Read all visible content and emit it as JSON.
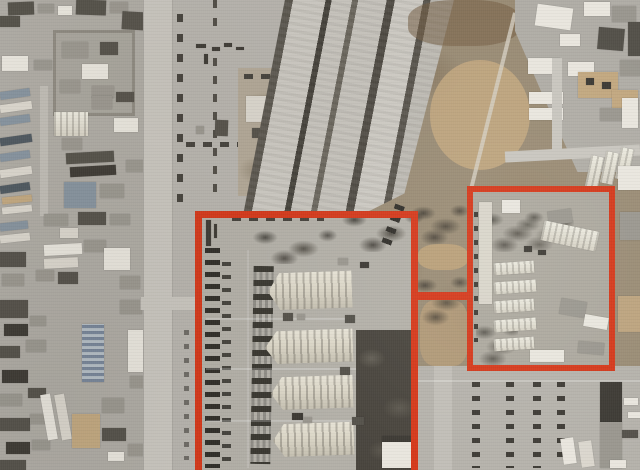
{
  "window": {
    "width": 640,
    "height": 470
  },
  "scene": {
    "kind": "satellite-aerial-photograph",
    "subject": "airbase-with-highlighted-compounds",
    "visible_text": ""
  },
  "annotation_color": "#d5381a",
  "annotations": [
    {
      "name": "highlight-box-main",
      "x": 195,
      "y": 211,
      "w": 223,
      "h": 266,
      "stroke": 7,
      "fill": false
    },
    {
      "name": "highlight-box-secondary",
      "x": 467,
      "y": 186,
      "w": 148,
      "h": 185,
      "stroke": 6,
      "fill": false
    },
    {
      "name": "highlight-connector",
      "x": 415,
      "y": 292,
      "w": 56,
      "h": 8,
      "stroke": 0,
      "fill": true
    }
  ],
  "palette": {
    "apron": "#b7b4ae",
    "urban": "#aeaba4",
    "road": "#c9c6bf",
    "dirt": "#9b8c74",
    "tan": "#c3a87e",
    "asphalt": "#49453e",
    "b_white": "#e9e6de",
    "b_gray": "#9a978f",
    "b_dark": "#54514a",
    "b_blue": "#8593a0",
    "b_navy": "#4e5860",
    "annotation": "#d5381a"
  }
}
